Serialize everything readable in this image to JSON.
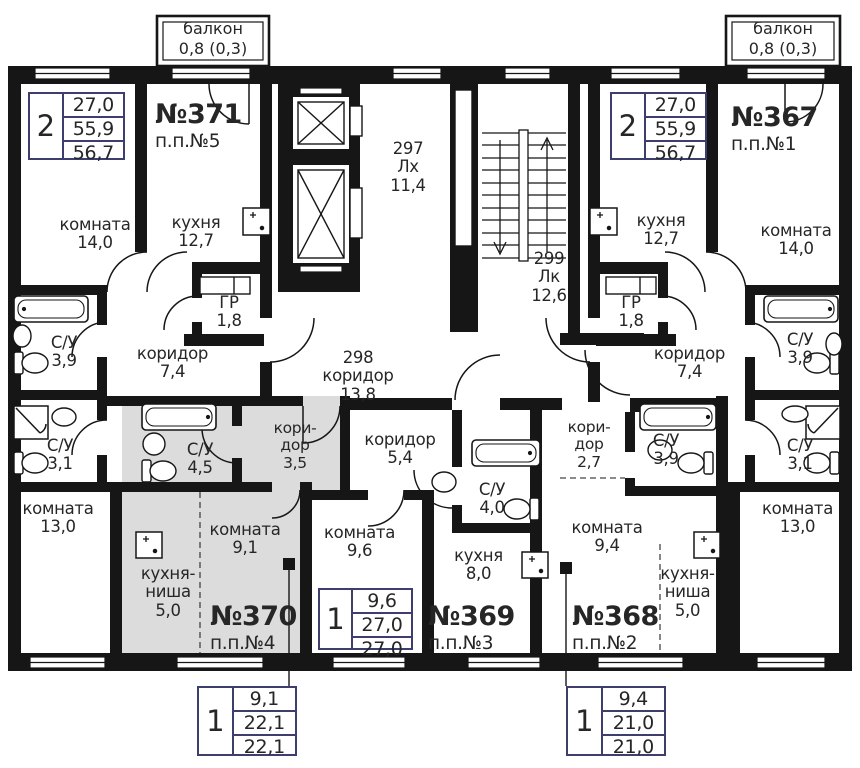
{
  "colors": {
    "wall": "#161616",
    "highlight": "#dcdcdc",
    "table_border": "#3e3e6e"
  },
  "balconies": {
    "left": {
      "name": "балкон",
      "area": "0,8 (0,3)"
    },
    "right": {
      "name": "балкон",
      "area": "0,8 (0,3)"
    }
  },
  "common_areas": {
    "lift_hall": {
      "id": "297",
      "type": "Лх",
      "area": "11,4"
    },
    "stairwell": {
      "id": "299",
      "type": "Лк",
      "area": "12,6"
    },
    "corridor": {
      "id": "298",
      "name": "коридор",
      "area": "13,8"
    }
  },
  "apartments": {
    "apt371": {
      "number": "№371",
      "plan_no": "п.п.№5",
      "rooms_count": "2",
      "areas": [
        "27,0",
        "55,9",
        "56,7"
      ]
    },
    "apt367": {
      "number": "№367",
      "plan_no": "п.п.№1",
      "rooms_count": "2",
      "areas": [
        "27,0",
        "55,9",
        "56,7"
      ]
    },
    "apt370": {
      "number": "№370",
      "plan_no": "п.п.№4",
      "rooms_count": "1",
      "areas": [
        "9,1",
        "22,1",
        "22,1"
      ]
    },
    "apt369": {
      "number": "№369",
      "plan_no": "п.п.№3",
      "rooms_count": "1",
      "areas": [
        "9,6",
        "27,0",
        "27,0"
      ]
    },
    "apt368": {
      "number": "№368",
      "plan_no": "п.п.№2",
      "rooms_count": "1",
      "areas": [
        "9,4",
        "21,0",
        "21,0"
      ]
    }
  },
  "rooms": {
    "komnata14_l": {
      "name": "комната",
      "area": "14,0"
    },
    "kuhnya_l": {
      "name": "кухня",
      "area": "12,7"
    },
    "gr_l": {
      "name": "ГР",
      "area": "1,8"
    },
    "koridor_l": {
      "name": "коридор",
      "area": "7,4"
    },
    "su39_l": {
      "name": "С/У",
      "area": "3,9"
    },
    "su31_l": {
      "name": "С/У",
      "area": "3,1"
    },
    "komnata13_l": {
      "name": "комната",
      "area": "13,0"
    },
    "su45": {
      "name": "С/У",
      "area": "4,5"
    },
    "koridor35": {
      "name_lines": [
        "кори-",
        "дор"
      ],
      "area": "3,5"
    },
    "komnata91": {
      "name": "комната",
      "area": "9,1"
    },
    "nisha_l": {
      "name_lines": [
        "кухня-",
        "ниша"
      ],
      "area": "5,0"
    },
    "koridor54": {
      "name": "коридор",
      "area": "5,4"
    },
    "komnata96": {
      "name": "комната",
      "area": "9,6"
    },
    "su40": {
      "name": "С/У",
      "area": "4,0"
    },
    "kuhnya80": {
      "name": "кухня",
      "area": "8,0"
    },
    "koridor27": {
      "name_lines": [
        "кори-",
        "дор"
      ],
      "area": "2,7"
    },
    "su39_m": {
      "name": "С/У",
      "area": "3,9"
    },
    "komnata94": {
      "name": "комната",
      "area": "9,4"
    },
    "nisha_r": {
      "name_lines": [
        "кухня-",
        "ниша"
      ],
      "area": "5,0"
    },
    "kuhnya_r": {
      "name": "кухня",
      "area": "12,7"
    },
    "komnata14_r": {
      "name": "комната",
      "area": "14,0"
    },
    "gr_r": {
      "name": "ГР",
      "area": "1,8"
    },
    "koridor_r": {
      "name": "коридор",
      "area": "7,4"
    },
    "su39_r": {
      "name": "С/У",
      "area": "3,9"
    },
    "su31_r": {
      "name": "С/У",
      "area": "3,1"
    },
    "komnata13_r": {
      "name": "комната",
      "area": "13,0"
    }
  }
}
